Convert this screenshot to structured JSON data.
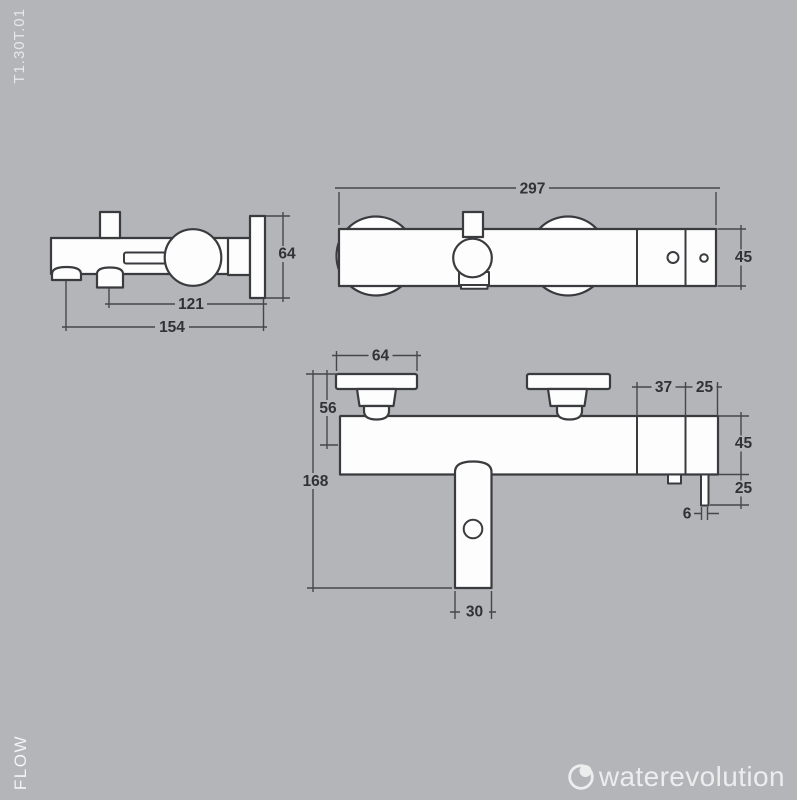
{
  "page": {
    "colors": {
      "background": "#b3b5b8",
      "outline": "#3a3b3e",
      "dimension_lines": "#46474a",
      "dimension_text": "#313235",
      "shape_fill": "#fdfdfd",
      "light_text": "#e7e8ea"
    }
  },
  "side_text": {
    "model_code": "T1.30T.01",
    "flow_label": "FLOW"
  },
  "brand": {
    "name": "waterevolution",
    "icon": "water-drop-circle-icon"
  },
  "views": {
    "side": {
      "title": "side-view",
      "dims": {
        "plate_height": "64",
        "wall_to_outlet": "121",
        "total_depth": "154"
      }
    },
    "front": {
      "title": "front-view",
      "dims": {
        "total_width": "297",
        "body_height": "45"
      }
    },
    "top": {
      "title": "bottom-front-view",
      "dims": {
        "flange_width": "64",
        "wall_to_axis": "56",
        "total_height": "168",
        "body_right_seg": "37",
        "end_seg": "25",
        "body_height": "45",
        "pin_length": "25",
        "pin_width": "6",
        "spout_width": "30"
      }
    }
  }
}
